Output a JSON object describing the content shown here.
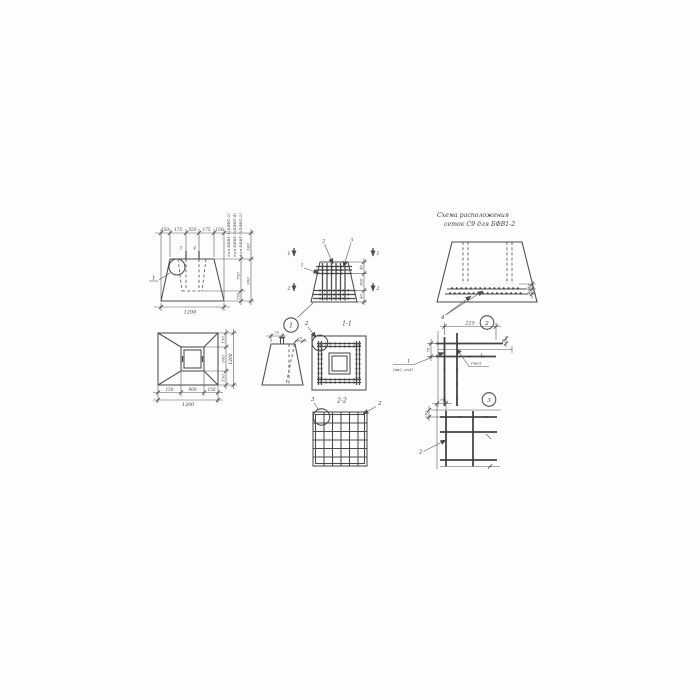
{
  "page": {
    "background": "#fdfdfd",
    "ink": "#4b4b4b"
  },
  "schema_view": {
    "title_line1": "Схема  расположения",
    "title_line2": "сеток С9    для БФВ1-2",
    "leader_mesh": "4",
    "dim_gap_top": "40",
    "dim_gap_bottom": "40"
  },
  "elevation_view": {
    "dim_top_1": "150",
    "dim_top_2": "175",
    "dim_top_3": "550",
    "dim_top_4": "175",
    "dim_top_5": "150",
    "dim_bottom_total": "1200",
    "dim_cavity_depth": "750",
    "dim_bottom_thickness": "150",
    "dim_pin": "300",
    "dim_height": "900",
    "note_rotated_1": "для БФВ1-1(БФВ1-2)",
    "note_rotated_2": "для БФВ1-3(БФВ1-4)",
    "note_rotated_3": "для БФВ1-5(БФВ1-2)",
    "leader_detail": "1",
    "pin_label_left": "3",
    "pin_label_right": "4"
  },
  "reinforcement_view": {
    "section_mark_top": "1",
    "section_mark_bottom": "2",
    "leader_top_left": "2",
    "leader_top_right": "3",
    "leader_left": "1",
    "dim_right_top": "40",
    "dim_right_mid": "820",
    "dim_right_bottom": "40"
  },
  "plan_view": {
    "dim_bottom_left": "150",
    "dim_bottom_mid": "900",
    "dim_bottom_right": "150",
    "dim_bottom_total": "1200",
    "dim_right_top": "150",
    "dim_right_mid": "900",
    "dim_right_bottom": "150",
    "dim_right_total": "1200"
  },
  "pin_detail_view": {
    "bubble": "1",
    "dim_offset": "75",
    "dim_top": "25"
  },
  "section_1_1": {
    "label": "1-1",
    "leader_mesh": "2"
  },
  "section_2_2": {
    "label": "2-2",
    "leader_left": "3",
    "leader_right": "2"
  },
  "corner_detail_view": {
    "bubble": "2",
    "dim_top": "225",
    "dim_left": "75",
    "dim_right": "50",
    "leader_left_num": "1",
    "leader_left_note": "(пв2, сп3)",
    "leader_right_num": "1",
    "leader_right_note": "(пв2)"
  },
  "mesh_corner_detail_view": {
    "bubble": "3",
    "dim_top": "75",
    "dim_left": "50",
    "leader_bar": "2"
  }
}
